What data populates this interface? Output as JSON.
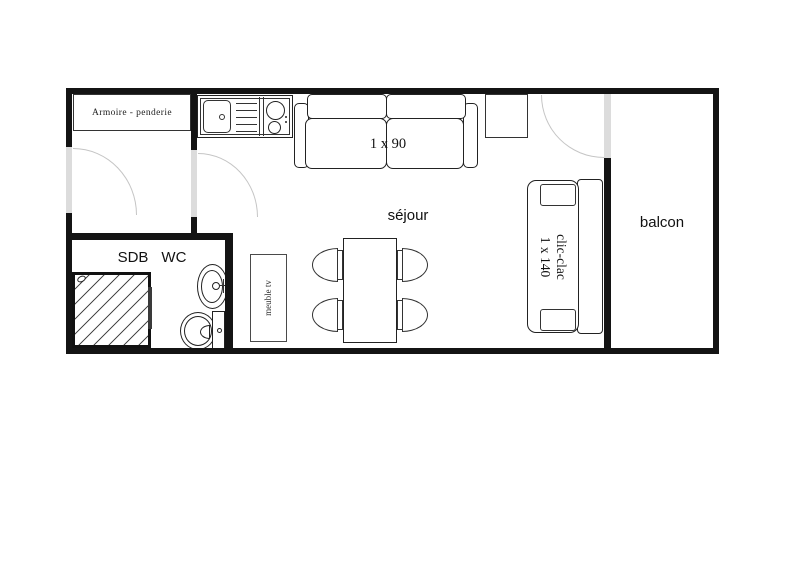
{
  "plan": {
    "rooms": {
      "living": "séjour",
      "balcony": "balcon",
      "bathroom": "SDB",
      "wc": "WC"
    },
    "furniture": {
      "wardrobe": "Armoire - penderie",
      "single_bed": "1 x 90",
      "sofa_bed_name": "clic-clac",
      "sofa_bed_size": "1 x 140",
      "tv_unit": "meuble tv"
    },
    "colors": {
      "wall": "#141414",
      "door_opening": "#dcdcdc",
      "door_arc": "#c5c5c5",
      "furniture_line": "#222222"
    }
  }
}
